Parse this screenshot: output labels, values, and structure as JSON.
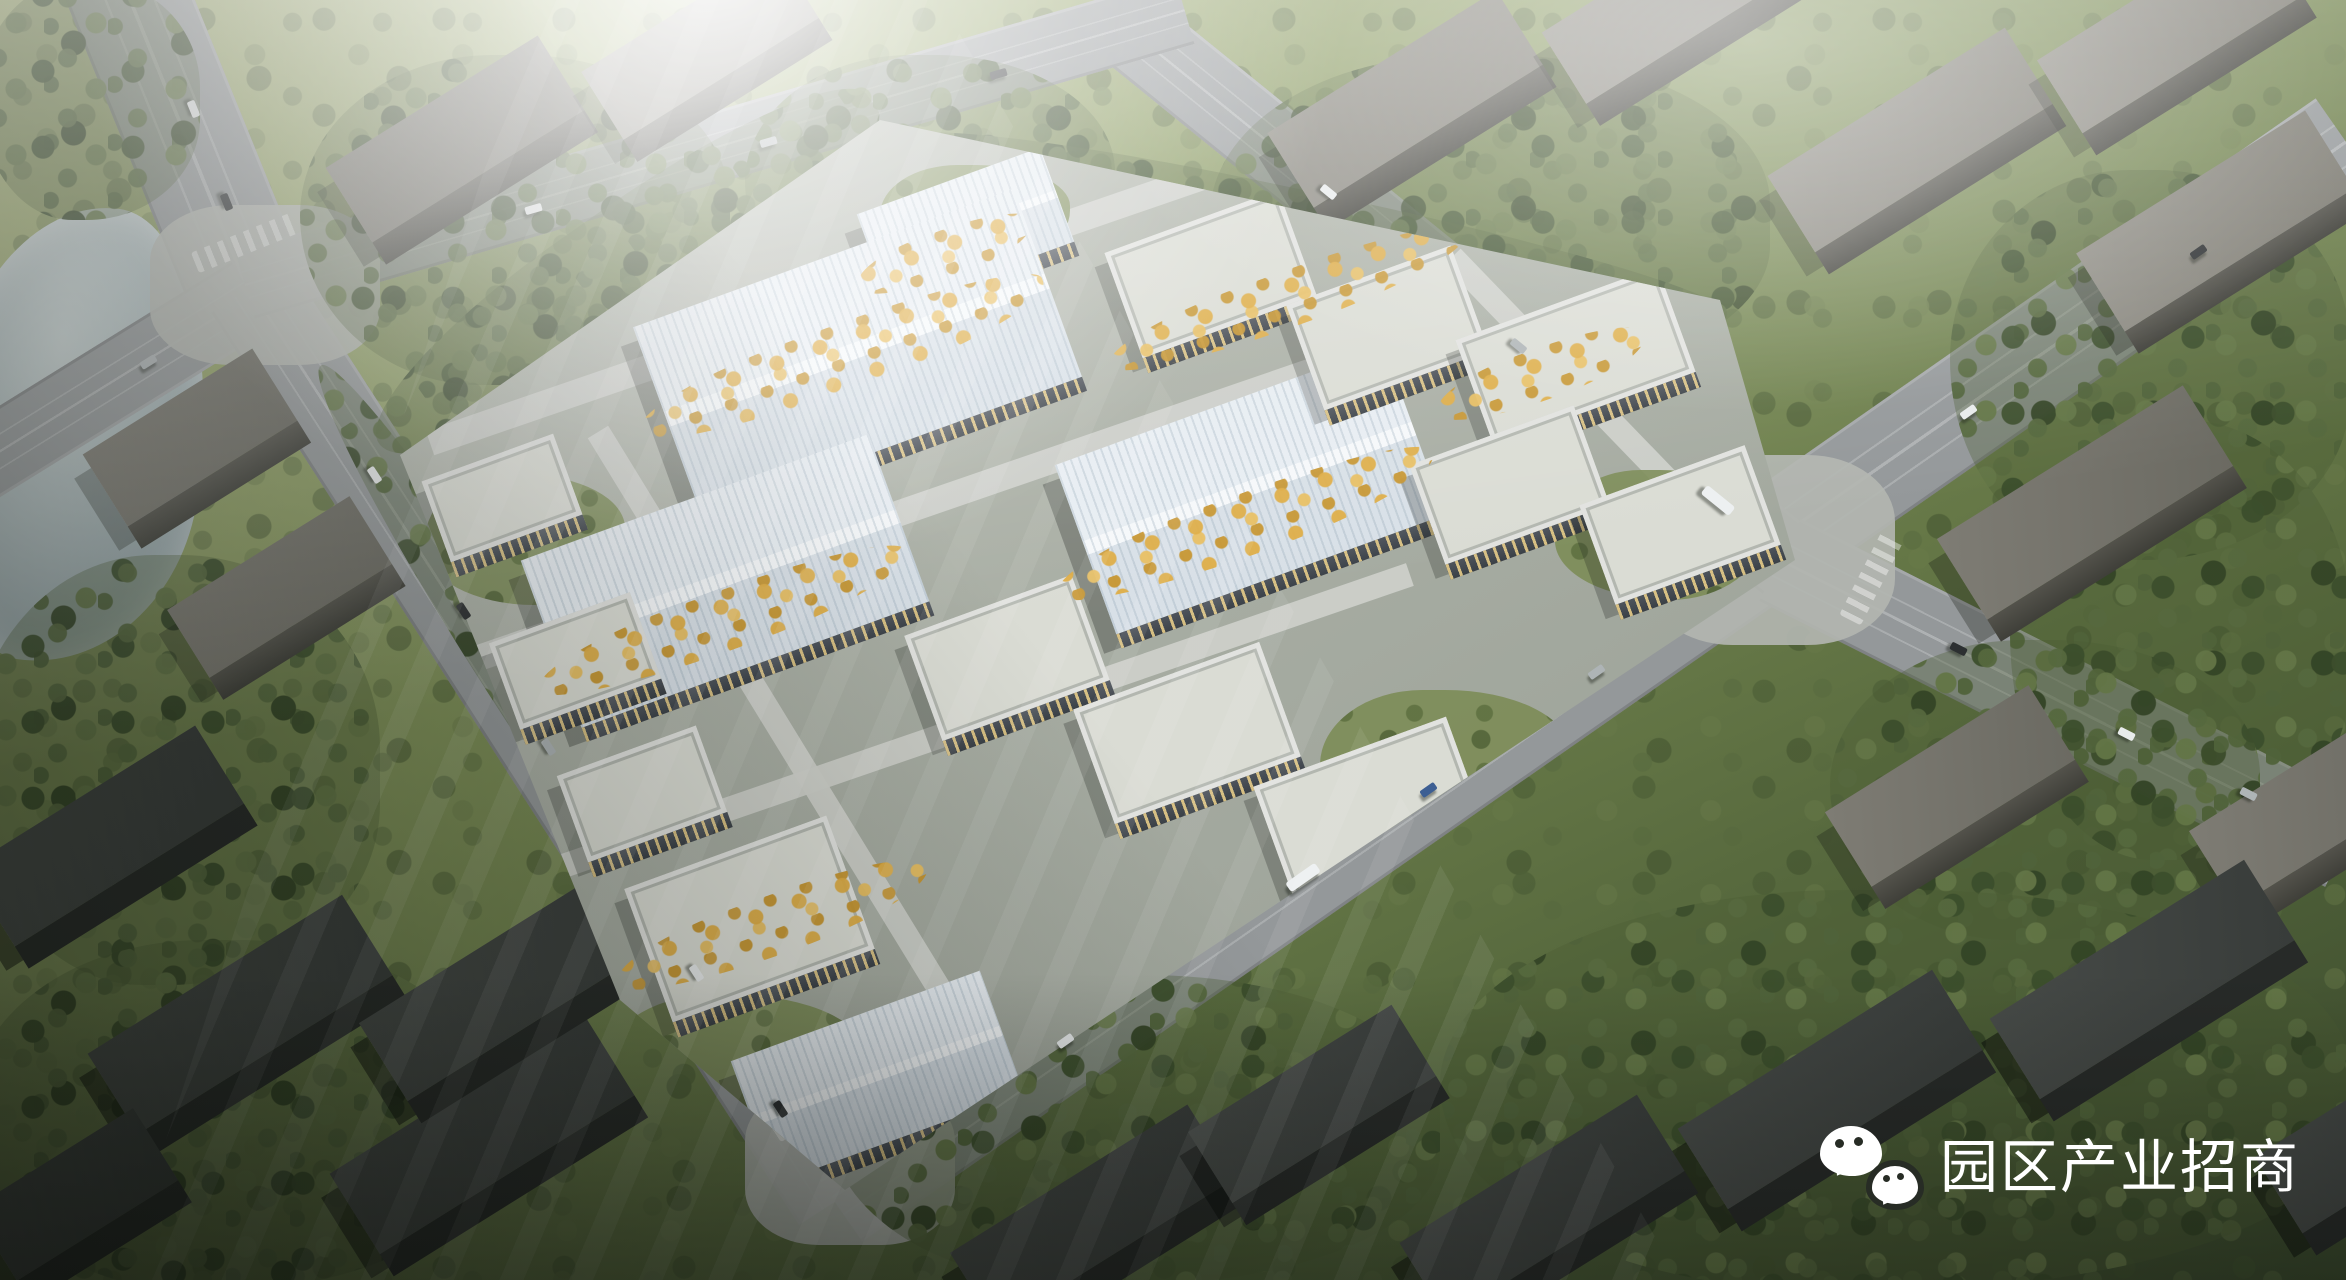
{
  "scene": {
    "type": "aerial architectural rendering",
    "subject": "industrial park campus of light-roofed workshop and office buildings surrounded by grey massing blocks, tree belts, boulevards and a pond",
    "lighting": "hazy sun glare from top center"
  },
  "watermark": {
    "icon": "wechat-icon",
    "text": "园区产业招商",
    "color": "#ffffff"
  },
  "palette": {
    "roof": "#e7edf2",
    "roof_ridge": "#f5f8fa",
    "roof_shade": "#d8e0e7",
    "flat_roof": "#dadcd4",
    "facade": "#4e545c",
    "window_glow": "#f0d48c",
    "ctx_top": "#7e7c74",
    "ctx_top2": "#6b6a62",
    "ctx_side": "#53524b",
    "road": "#94989a",
    "park_ground": "#aab0a6",
    "tree_green": "#55683e",
    "tree_yellow": "#d8a94e",
    "water": "#a5b4b7",
    "wm_color": "#ffffff"
  },
  "vehicles": {
    "cars": 21,
    "buses": 2
  }
}
